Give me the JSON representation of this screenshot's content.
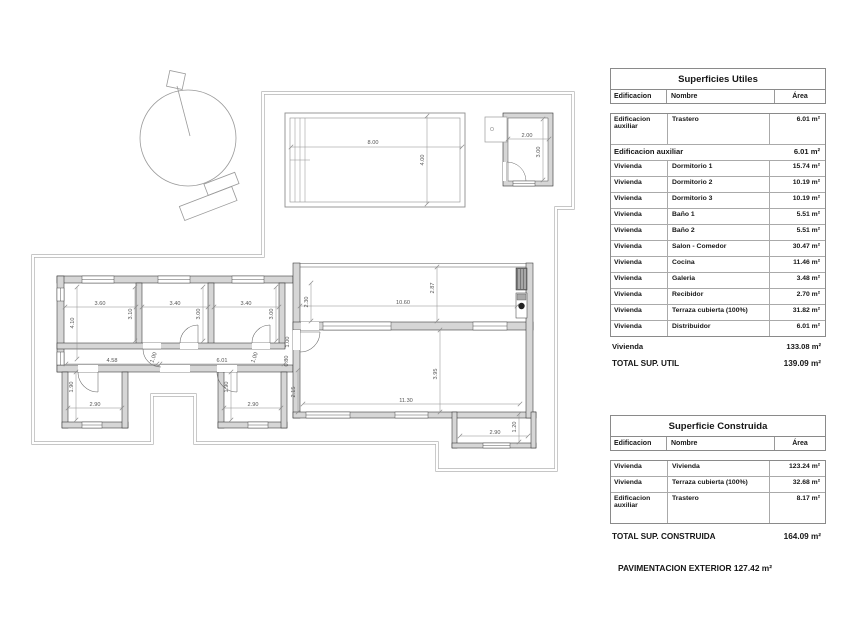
{
  "plan": {
    "dims": [
      {
        "t": "8.00",
        "x": 373,
        "y": 144,
        "r": 0
      },
      {
        "t": "4.00",
        "x": 424,
        "y": 160,
        "r": -90
      },
      {
        "t": "2.00",
        "x": 527,
        "y": 137,
        "r": 0
      },
      {
        "t": "3.00",
        "x": 540,
        "y": 152,
        "r": -90
      },
      {
        "t": "3.60",
        "x": 100,
        "y": 305,
        "r": 0
      },
      {
        "t": "3.40",
        "x": 175,
        "y": 305,
        "r": 0
      },
      {
        "t": "3.40",
        "x": 246,
        "y": 305,
        "r": 0
      },
      {
        "t": "4.10",
        "x": 74,
        "y": 323,
        "r": -90
      },
      {
        "t": "3.10",
        "x": 132,
        "y": 314,
        "r": -90
      },
      {
        "t": "3.00",
        "x": 200,
        "y": 314,
        "r": -90
      },
      {
        "t": "3.00",
        "x": 273,
        "y": 314,
        "r": -90
      },
      {
        "t": "2.30",
        "x": 308,
        "y": 302,
        "r": -90
      },
      {
        "t": "10.60",
        "x": 403,
        "y": 304,
        "r": 0
      },
      {
        "t": "2.87",
        "x": 434,
        "y": 288,
        "r": -90
      },
      {
        "t": "4.58",
        "x": 112,
        "y": 362,
        "r": 0
      },
      {
        "t": "1.00",
        "x": 155,
        "y": 358,
        "r": -70
      },
      {
        "t": "6.01",
        "x": 222,
        "y": 362,
        "r": 0
      },
      {
        "t": "1.00",
        "x": 256,
        "y": 358,
        "r": -70
      },
      {
        "t": "1.00",
        "x": 289,
        "y": 342,
        "r": -90
      },
      {
        "t": "0.80",
        "x": 288,
        "y": 361,
        "r": -90
      },
      {
        "t": "2.15",
        "x": 295,
        "y": 392,
        "r": -90
      },
      {
        "t": "1.90",
        "x": 73,
        "y": 387,
        "r": -90
      },
      {
        "t": "2.90",
        "x": 95,
        "y": 406,
        "r": 0
      },
      {
        "t": "1.90",
        "x": 228,
        "y": 387,
        "r": -90
      },
      {
        "t": "2.90",
        "x": 253,
        "y": 406,
        "r": 0
      },
      {
        "t": "3.95",
        "x": 437,
        "y": 374,
        "r": -90
      },
      {
        "t": "11.30",
        "x": 406,
        "y": 402,
        "r": 0
      },
      {
        "t": "2.90",
        "x": 495,
        "y": 434,
        "r": 0
      },
      {
        "t": "1.20",
        "x": 516,
        "y": 427,
        "r": -90
      }
    ]
  },
  "tables": {
    "utiles": {
      "title": "Superficies Utiles",
      "col_edificacion": "Edificacion",
      "col_nombre": "Nombre",
      "col_area": "Área",
      "rows": [
        {
          "type": "tall",
          "edificacion": "Edificacion auxiliar",
          "nombre": "Trastero",
          "area": "6.01 m²"
        },
        {
          "type": "subtotal",
          "edificacion": "Edificacion auxiliar",
          "nombre": "",
          "area": "6.01 m²"
        },
        {
          "edificacion": "Vivienda",
          "nombre": "Dormitorio 1",
          "area": "15.74 m²"
        },
        {
          "edificacion": "Vivienda",
          "nombre": "Dormitorio 2",
          "area": "10.19 m²"
        },
        {
          "edificacion": "Vivienda",
          "nombre": "Dormitorio 3",
          "area": "10.19 m²"
        },
        {
          "edificacion": "Vivienda",
          "nombre": "Baño 1",
          "area": "5.51 m²"
        },
        {
          "edificacion": "Vivienda",
          "nombre": "Baño 2",
          "area": "5.51 m²"
        },
        {
          "edificacion": "Vivienda",
          "nombre": "Salon - Comedor",
          "area": "30.47 m²"
        },
        {
          "edificacion": "Vivienda",
          "nombre": "Cocina",
          "area": "11.46 m²"
        },
        {
          "edificacion": "Vivienda",
          "nombre": "Galeria",
          "area": "3.48 m²"
        },
        {
          "edificacion": "Vivienda",
          "nombre": "Recibidor",
          "area": "2.70 m²"
        },
        {
          "edificacion": "Vivienda",
          "nombre": "Terraza cubierta (100%)",
          "area": "31.82 m²"
        },
        {
          "edificacion": "Vivienda",
          "nombre": "Distribuidor",
          "area": "6.01 m²"
        }
      ],
      "totals": [
        {
          "type": "sub",
          "label": "Vivienda",
          "area": "133.08 m²"
        },
        {
          "type": "grand",
          "label": "TOTAL SUP. UTIL",
          "area": "139.09 m²"
        }
      ]
    },
    "construida": {
      "title": "Superficie Construida",
      "col_edificacion": "Edificacion",
      "col_nombre": "Nombre",
      "col_area": "Área",
      "rows": [
        {
          "edificacion": "Vivienda",
          "nombre": "Vivienda",
          "area": "123.24 m²"
        },
        {
          "edificacion": "Vivienda",
          "nombre": "Terraza cubierta (100%)",
          "area": "32.68 m²"
        },
        {
          "type": "tall",
          "edificacion": "Edificacion auxiliar",
          "nombre": "Trastero",
          "area": "8.17 m²"
        }
      ],
      "totals": [
        {
          "type": "grand",
          "label": "TOTAL SUP. CONSTRUIDA",
          "area": "164.09 m²"
        }
      ]
    }
  },
  "footer": {
    "pavimentacion": "PAVIMENTACION EXTERIOR 127.42 m²"
  }
}
